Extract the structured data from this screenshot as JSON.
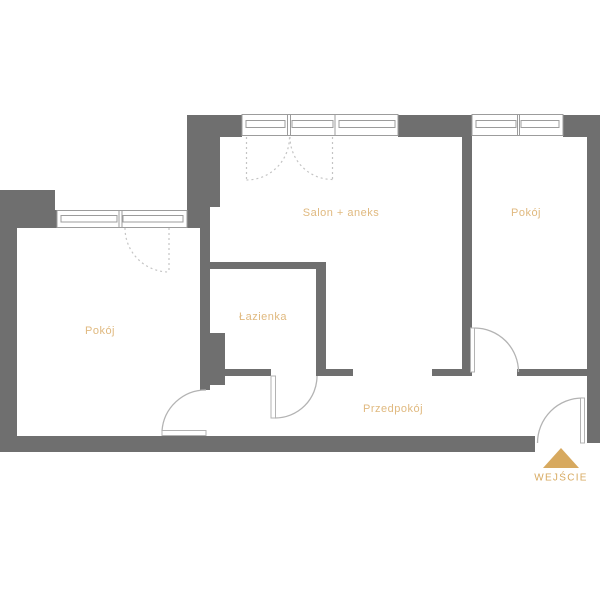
{
  "plan": {
    "rooms": [
      {
        "id": "salon",
        "label": "Salon + aneks"
      },
      {
        "id": "pokoj-right",
        "label": "Pokój"
      },
      {
        "id": "lazienka",
        "label": "Łazienka"
      },
      {
        "id": "pokoj-left",
        "label": "Pokój"
      },
      {
        "id": "przedpokoj",
        "label": "Przedpokój"
      }
    ],
    "entrance_label": "WEJŚCIE"
  },
  "colors": {
    "wall": "#6f6f6f",
    "line": "#b3b3b3",
    "dash": "#c4c4c4",
    "frame": "#9c9c9c",
    "label": "#e0b97f",
    "accent": "#d7a95f",
    "background": "#ffffff"
  }
}
